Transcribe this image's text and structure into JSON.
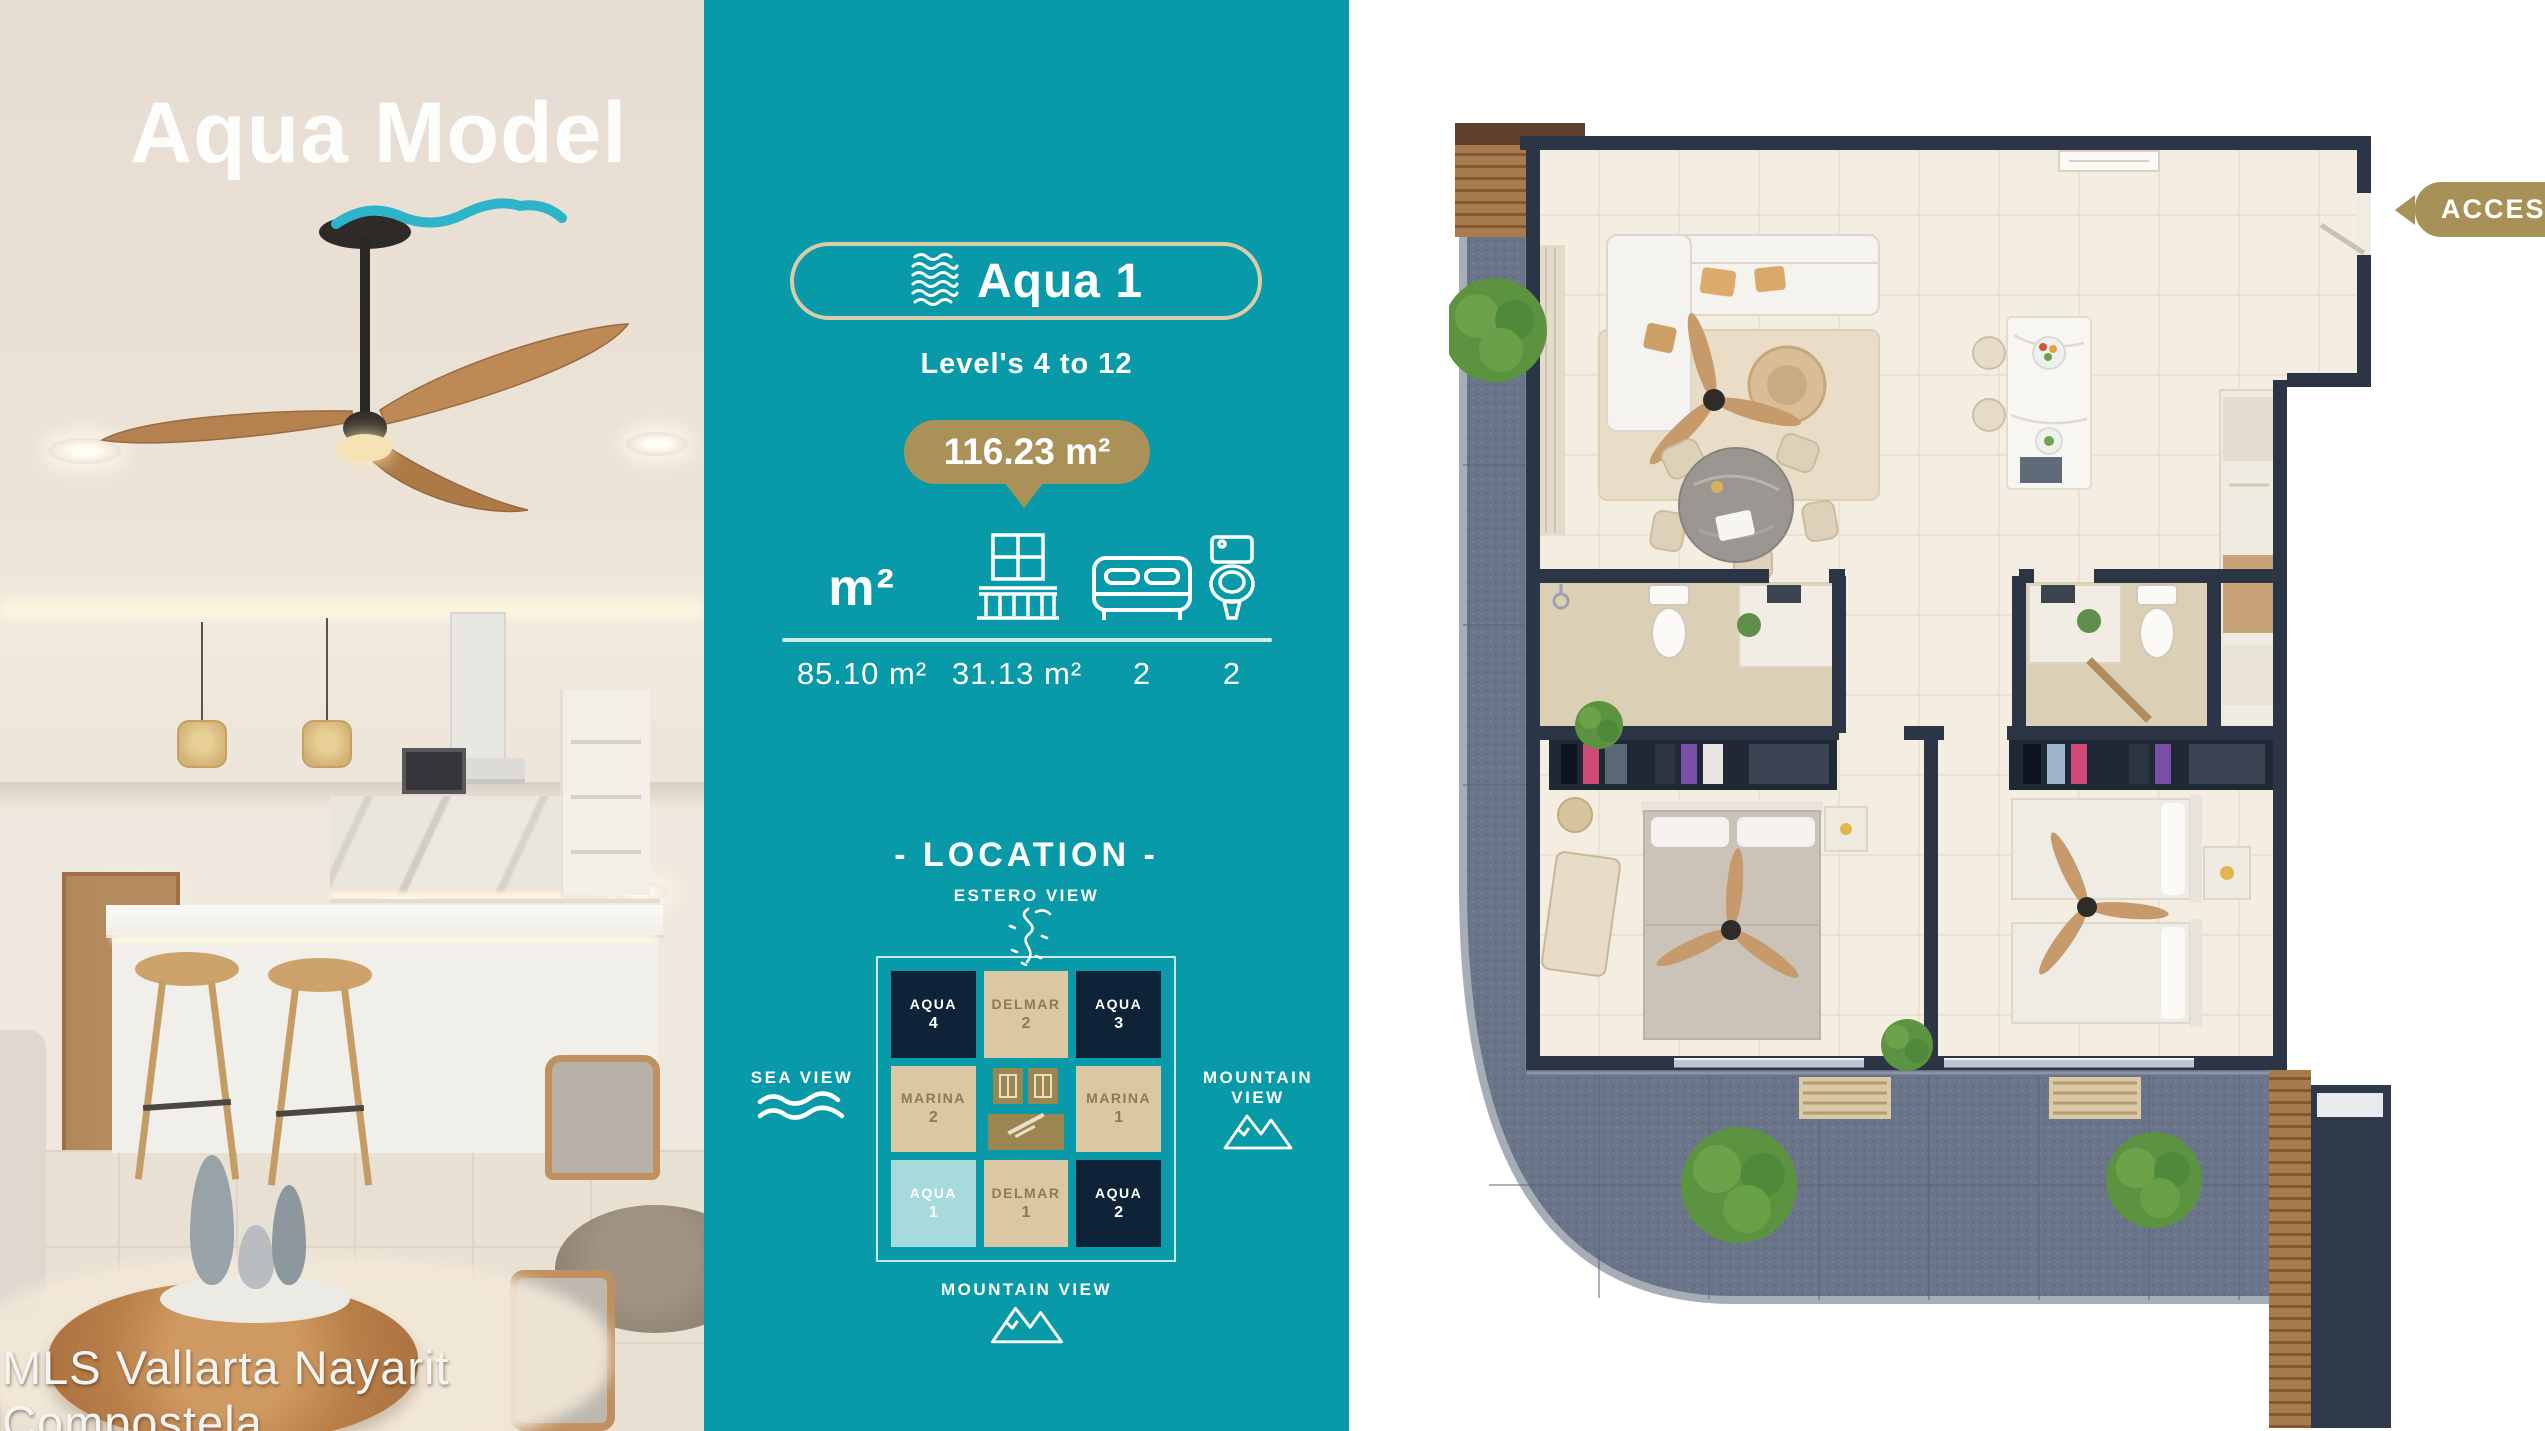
{
  "photo": {
    "title": "Aqua Model",
    "watermark": "MLS Vallarta Nayarit Compostela"
  },
  "unit": {
    "name": "Aqua 1",
    "levels": "Level's 4 to 12",
    "total_area": "116.23 m²",
    "specs": [
      {
        "label": "m²",
        "value": "85.10 m²"
      },
      {
        "label": "balcony",
        "value": "31.13 m²"
      },
      {
        "label": "bedrooms",
        "value": "2"
      },
      {
        "label": "bathrooms",
        "value": "2"
      }
    ]
  },
  "location": {
    "heading": "- LOCATION -",
    "views": {
      "top": "ESTERO VIEW",
      "left": "SEA VIEW",
      "right": "MOUNTAIN VIEW",
      "bottom": "MOUNTAIN VIEW"
    },
    "grid": {
      "rows": [
        [
          {
            "name": "AQUA",
            "num": "4"
          },
          {
            "name": "DELMAR",
            "num": "2"
          },
          {
            "name": "AQUA",
            "num": "3"
          }
        ],
        [
          {
            "name": "MARINA",
            "num": "2"
          },
          {
            "name": "",
            "num": ""
          },
          {
            "name": "MARINA",
            "num": "1"
          }
        ],
        [
          {
            "name": "AQUA",
            "num": "1"
          },
          {
            "name": "DELMAR",
            "num": "1"
          },
          {
            "name": "AQUA",
            "num": "2"
          }
        ]
      ]
    }
  },
  "plan": {
    "access": "ACCESS"
  },
  "colors": {
    "teal": "#089aa8",
    "gold": "#a99157",
    "navy_cell": "#0e2338",
    "tan_cell": "#d9c8a2",
    "highlight_cell": "#a6dadc",
    "wall": "#2b3545",
    "balcony": "#6b7589",
    "floor": "#f3eee1"
  }
}
